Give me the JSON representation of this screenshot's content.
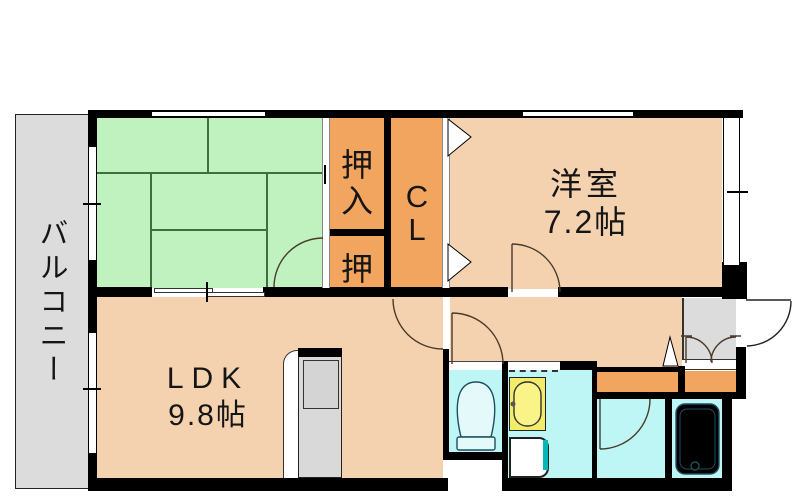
{
  "floorplan": {
    "balcony_label": "バルコニー",
    "closet_upper_label": "押入",
    "closet_lower_label": "押",
    "cl_label": "CL",
    "western_room": {
      "name": "洋室",
      "area": "7.2帖"
    },
    "ldk": {
      "name": "LDK",
      "area": "9.8帖"
    }
  },
  "colors": {
    "wall": "#000000",
    "line": "#333333",
    "peach": "#f4d2b0",
    "green": "#c0f2c0",
    "orange": "#f2a55e",
    "cyan": "#bef6f6",
    "gray": "#dcdcdc",
    "yellow": "#f2ec6a",
    "teal": "#00b8b8",
    "tatamiline": "#3f6f3f",
    "fixture": "#1f4f5f",
    "doorarc": "#4a3b2a"
  }
}
